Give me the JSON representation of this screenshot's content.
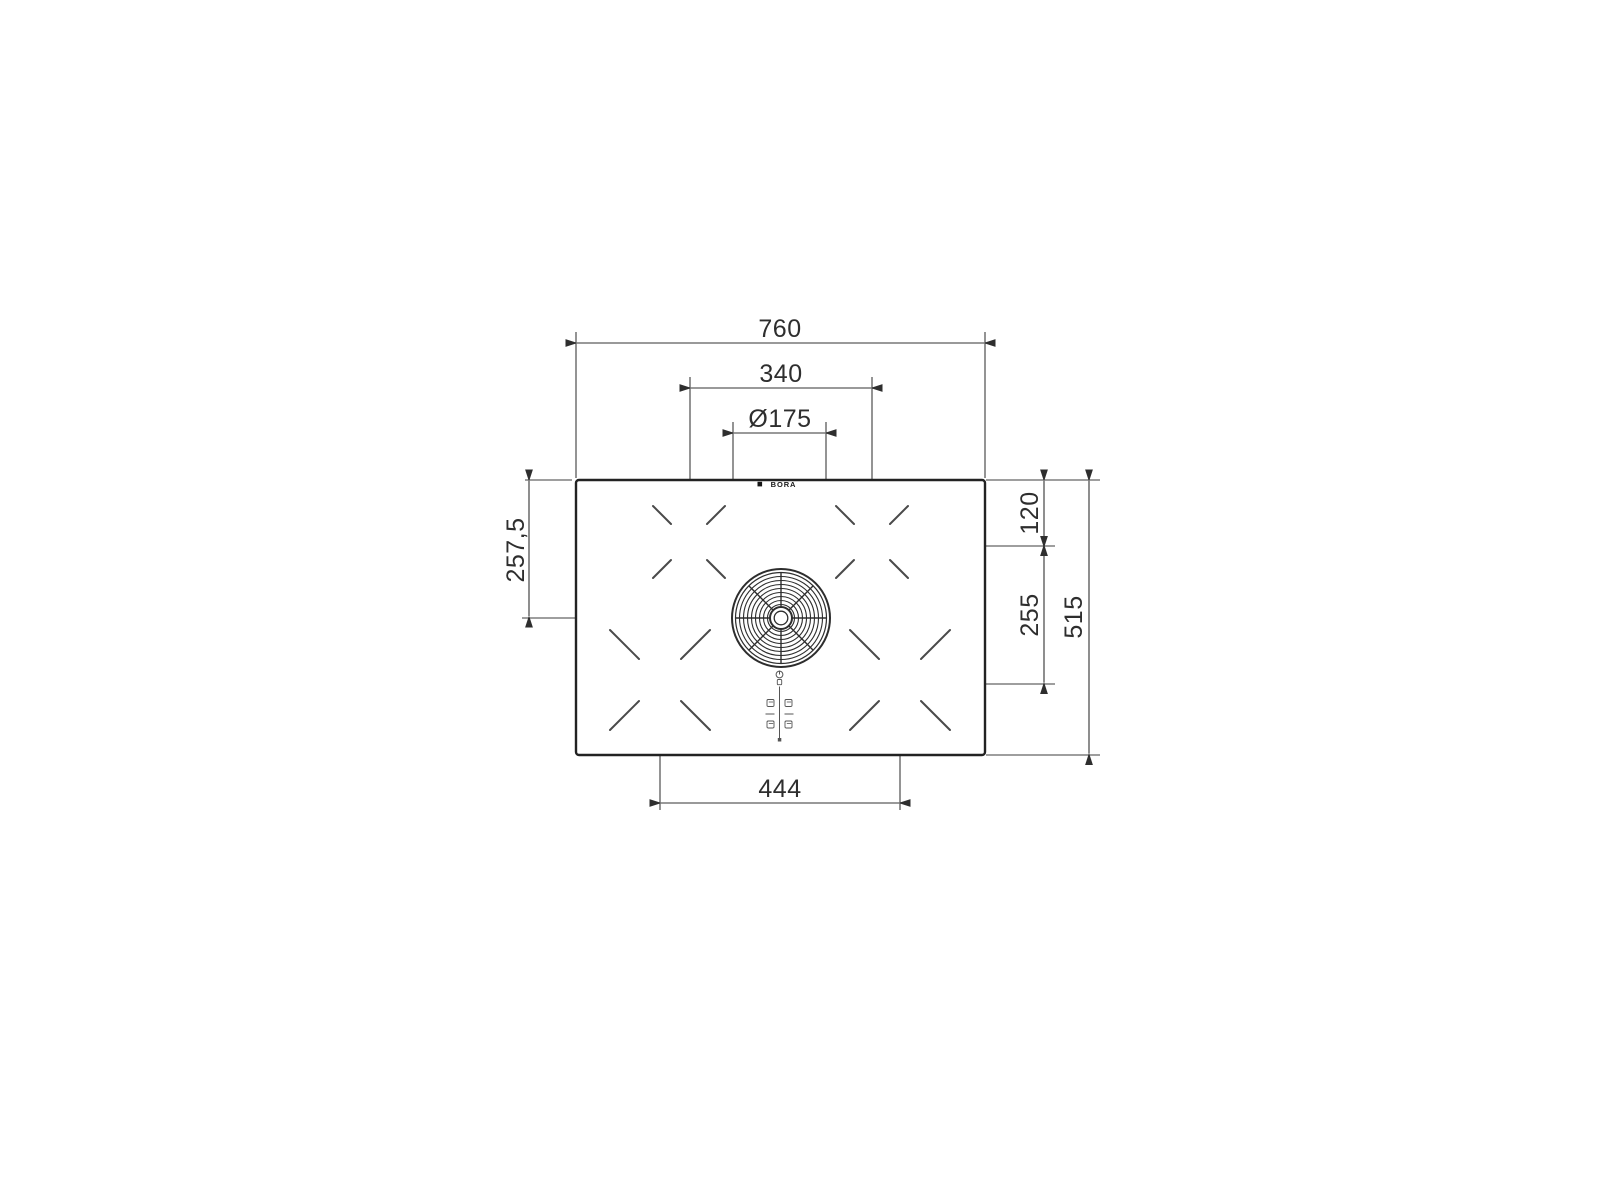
{
  "drawing": {
    "type": "cooktop-installation-dimension-drawing",
    "logo": {
      "brand": "BORA"
    },
    "dimensions": {
      "total_width": "760",
      "top_zone_spacing": "340",
      "vent_diameter": "Ø175",
      "left_center_offset": "257,5",
      "right_top_offset": "120",
      "right_zone_spacing": "255",
      "total_depth": "515",
      "bottom_zone_spacing": "444"
    }
  }
}
